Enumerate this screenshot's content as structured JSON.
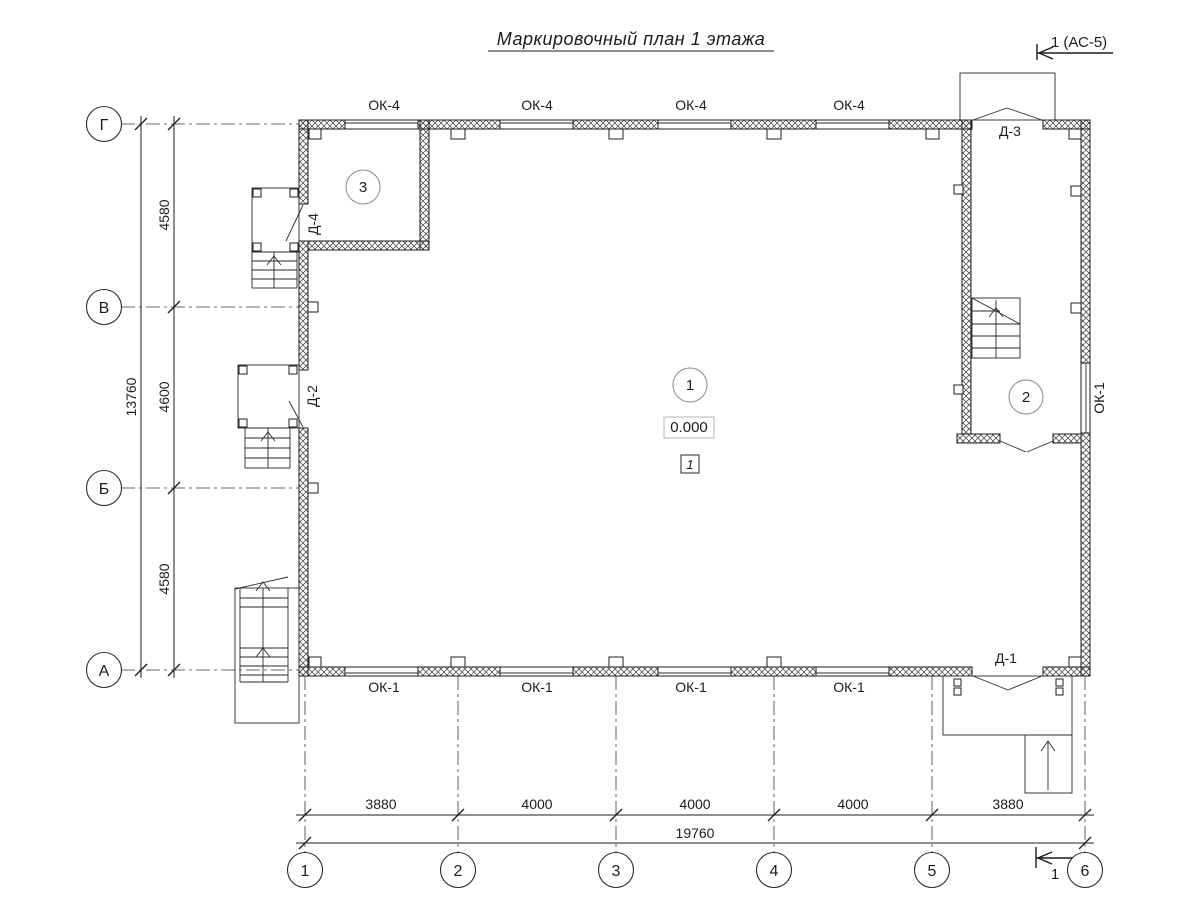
{
  "title": "Маркировочный план 1 этажа",
  "section_mark_top": "1 (АС-5)",
  "section_mark_bottom": "1",
  "axes_letters": [
    "Г",
    "В",
    "Б",
    "А"
  ],
  "axes_numbers": [
    "1",
    "2",
    "3",
    "4",
    "5",
    "6"
  ],
  "dims": {
    "v_segments": [
      "4580",
      "4600",
      "4580"
    ],
    "v_total": "13760",
    "h_segments": [
      "3880",
      "4000",
      "4000",
      "4000",
      "3880"
    ],
    "h_total": "19760"
  },
  "windows_top": [
    "ОК-4",
    "ОК-4",
    "ОК-4",
    "ОК-4"
  ],
  "windows_bottom": [
    "ОК-1",
    "ОК-1",
    "ОК-1",
    "ОК-1"
  ],
  "window_right": "ОК-1",
  "doors": {
    "d1": "Д-1",
    "d2": "Д-2",
    "d3": "Д-3",
    "d4": "Д-4"
  },
  "rooms": [
    "1",
    "2",
    "3"
  ],
  "elevation": "0.000",
  "note_box": "1",
  "colors": {
    "ink": "#1c1c1c",
    "room_circle": "#8a8a8a",
    "elev_box_border": "#b5b5b5"
  }
}
